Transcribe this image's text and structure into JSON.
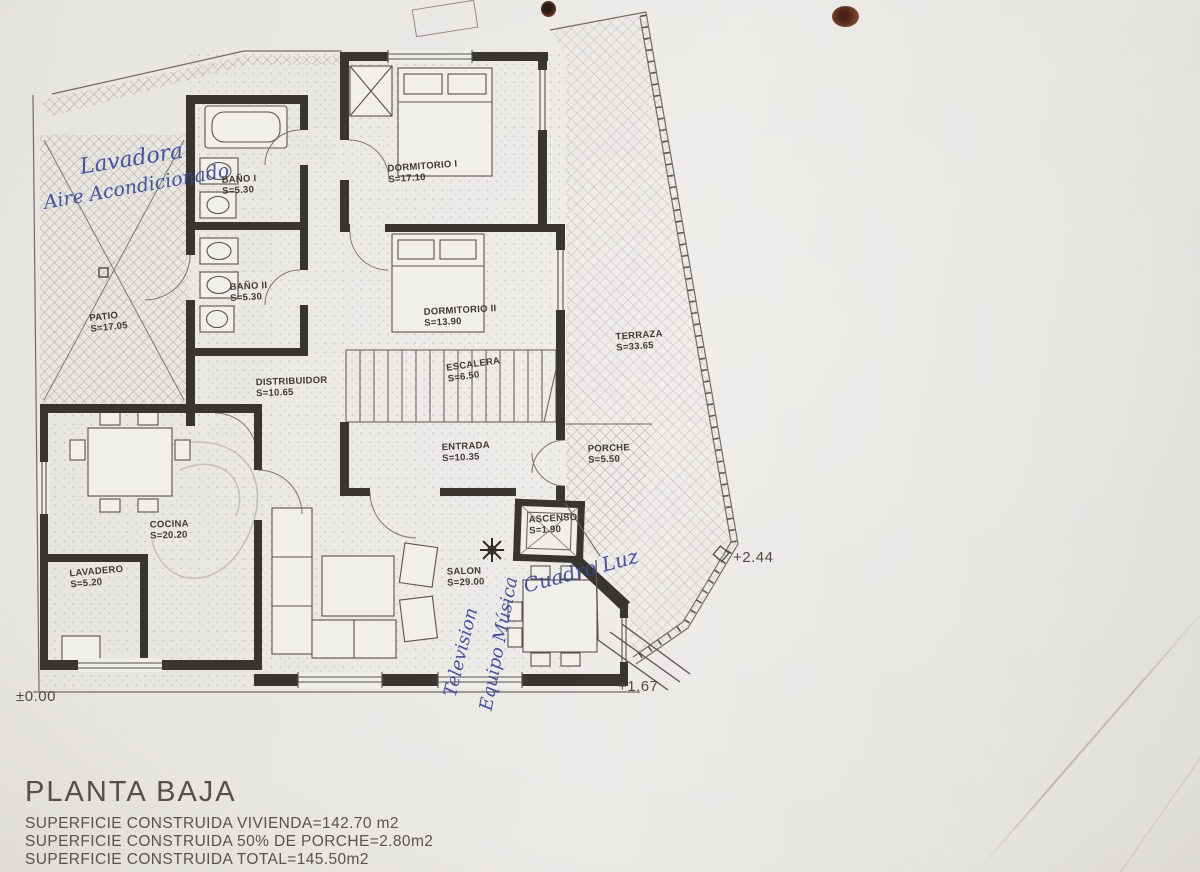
{
  "document": {
    "title": "PLANTA BAJA",
    "summary_lines": [
      "SUPERFICIE CONSTRUIDA VIVIENDA=142.70 m2",
      "SUPERFICIE CONSTRUIDA 50% DE PORCHE=2.80m2",
      "SUPERFICIE CONSTRUIDA TOTAL=145.50m2"
    ]
  },
  "rooms": [
    {
      "name": "BAÑO I",
      "area": "S=5.30"
    },
    {
      "name": "DORMITORIO I",
      "area": "S=17.10"
    },
    {
      "name": "BAÑO II",
      "area": "S=5.30"
    },
    {
      "name": "DORMITORIO II",
      "area": "S=13.90"
    },
    {
      "name": "PATIO",
      "area": "S=17.05"
    },
    {
      "name": "DISTRIBUIDOR",
      "area": "S=10.65"
    },
    {
      "name": "ESCALERA",
      "area": "S=6.50"
    },
    {
      "name": "TERRAZA",
      "area": "S=33.65"
    },
    {
      "name": "ENTRADA",
      "area": "S=10.35"
    },
    {
      "name": "PORCHE",
      "area": "S=5.50"
    },
    {
      "name": "ASCENSOR",
      "area": "S=1.90"
    },
    {
      "name": "COCINA",
      "area": "S=20.20"
    },
    {
      "name": "LAVADERO",
      "area": "S=5.20"
    },
    {
      "name": "SALON",
      "area": "S=29.00"
    }
  ],
  "levels": {
    "ground": "±0.00",
    "porch": "+1.67",
    "terrace": "+2.44"
  },
  "annotations": [
    {
      "text": "Lavadora"
    },
    {
      "text": "Aire Acondicionado"
    },
    {
      "text": "Television"
    },
    {
      "text": "Equipo Música"
    },
    {
      "text": "Cuadro Luz"
    }
  ],
  "colors": {
    "plan_ink": "#38342f",
    "hand_ink": "#3b4597",
    "paper": "#e8e6e2"
  }
}
